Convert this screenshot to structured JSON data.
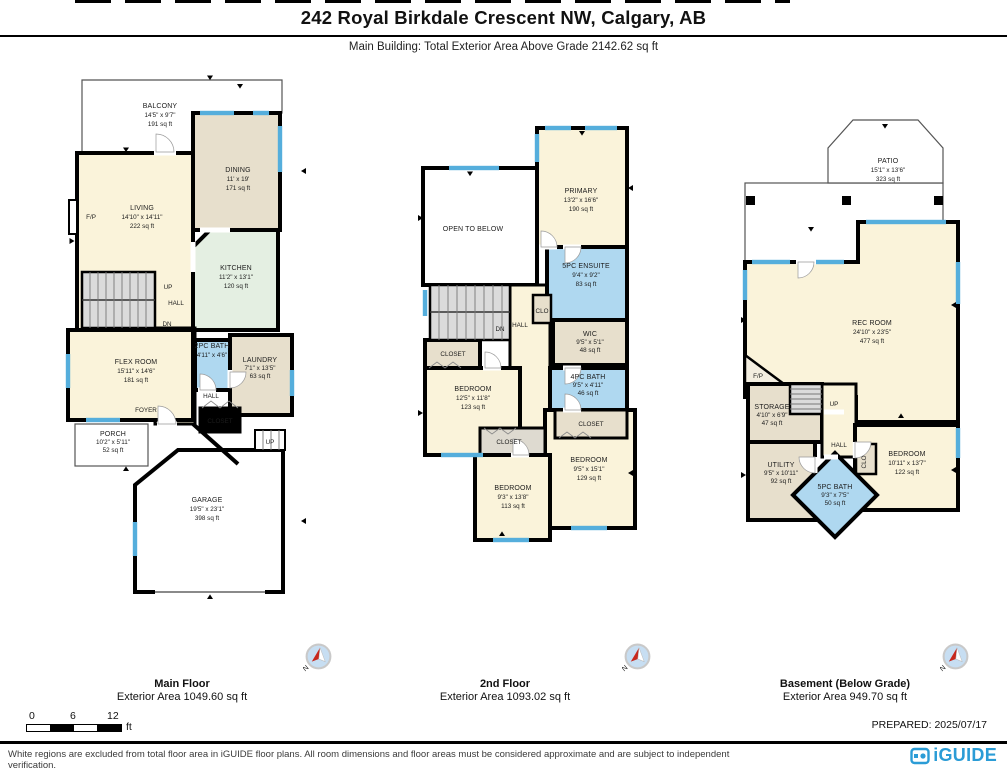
{
  "page": {
    "title": "242 Royal Birkdale Crescent NW, Calgary, AB",
    "subtitle": "Main Building: Total Exterior Area Above Grade 2142.62 sq ft",
    "prepared": "PREPARED: 2025/07/17",
    "disclaimer": "White regions are excluded from total floor area in iGUIDE floor plans. All room dimensions and floor areas must be considered approximate and are subject to independent verification.",
    "brand": "iGUIDE"
  },
  "scale_bar": {
    "t0": "0",
    "t6": "6",
    "t12": "12",
    "unit": "ft"
  },
  "compass": {
    "n": "N"
  },
  "colors": {
    "brand_blue": "#2B9CD6",
    "window_blue": "#55AEDC",
    "room_cream": "#FAF3DA",
    "room_tan": "#E7DFCC",
    "room_blue": "#AFD8F0",
    "room_green": "#E4EFE2",
    "stairs_gray": "#DBDBDB",
    "wall": "#000000"
  },
  "floors": [
    {
      "name": "Main Floor",
      "area_label": "Exterior Area 1049.60 sq ft",
      "rooms": {
        "balcony": {
          "n": "BALCONY",
          "d": "14'5\" x 9'7\"",
          "a": "191 sq ft"
        },
        "living": {
          "n": "LIVING",
          "d": "14'10\" x 14'11\"",
          "a": "222 sq ft"
        },
        "dining": {
          "n": "DINING",
          "d": "11' x 19'",
          "a": "171 sq ft"
        },
        "kitchen": {
          "n": "KITCHEN",
          "d": "11'2\" x 13'1\"",
          "a": "120 sq ft"
        },
        "flex": {
          "n": "FLEX ROOM",
          "d": "15'11\" x 14'6\"",
          "a": "181 sq ft"
        },
        "bath2": {
          "n": "2PC BATH",
          "d": "4'11\" x 4'6\""
        },
        "laundry": {
          "n": "LAUNDRY",
          "d": "7'1\" x 13'5\"",
          "a": "63 sq ft"
        },
        "porch": {
          "n": "PORCH",
          "d": "10'2\" x 5'11\"",
          "a": "52 sq ft"
        },
        "garage": {
          "n": "GARAGE",
          "d": "19'5\" x 23'1\"",
          "a": "398 sq ft"
        }
      },
      "ann": {
        "up": "UP",
        "dn": "DN",
        "hall": "HALL",
        "foyer": "FOYER",
        "closet": "CLOSET",
        "fp": "F/P"
      }
    },
    {
      "name": "2nd Floor",
      "area_label": "Exterior Area 1093.02 sq ft",
      "rooms": {
        "open": {
          "n": "OPEN TO BELOW"
        },
        "primary": {
          "n": "PRIMARY",
          "d": "13'2\" x 16'6\"",
          "a": "190 sq ft"
        },
        "ensuite": {
          "n": "5PC ENSUITE",
          "d": "9'4\" x 9'2\"",
          "a": "83 sq ft"
        },
        "wic": {
          "n": "WIC",
          "d": "9'5\" x 5'1\"",
          "a": "48 sq ft"
        },
        "bed1": {
          "n": "BEDROOM",
          "d": "12'5\" x 11'8\"",
          "a": "123 sq ft"
        },
        "bath4": {
          "n": "4PC BATH",
          "d": "9'5\" x 4'11\"",
          "a": "46 sq ft"
        },
        "bed2": {
          "n": "BEDROOM",
          "d": "9'5\" x 15'1\"",
          "a": "129 sq ft"
        },
        "bed3": {
          "n": "BEDROOM",
          "d": "9'3\" x 13'8\"",
          "a": "113 sq ft"
        }
      },
      "ann": {
        "dn": "DN",
        "hall": "HALL",
        "clo": "CLO",
        "closet": "CLOSET"
      }
    },
    {
      "name": "Basement (Below Grade)",
      "area_label": "Exterior Area 949.70 sq ft",
      "rooms": {
        "patio": {
          "n": "PATIO",
          "d": "15'1\" x 13'6\"",
          "a": "323 sq ft"
        },
        "rec": {
          "n": "REC ROOM",
          "d": "24'10\" x 23'5\"",
          "a": "477 sq ft"
        },
        "storage": {
          "n": "STORAGE",
          "d": "4'10\" x 6'9\"",
          "a": "47 sq ft"
        },
        "utility": {
          "n": "UTILITY",
          "d": "9'5\" x 10'11\"",
          "a": "92 sq ft"
        },
        "bed": {
          "n": "BEDROOM",
          "d": "10'11\" x 13'7\"",
          "a": "122 sq ft"
        },
        "bath5": {
          "n": "5PC BATH",
          "d": "9'3\" x 7'5\"",
          "a": "50 sq ft"
        }
      },
      "ann": {
        "up": "UP",
        "hall": "HALL",
        "clo": "CLO",
        "fp": "F/P"
      }
    }
  ]
}
